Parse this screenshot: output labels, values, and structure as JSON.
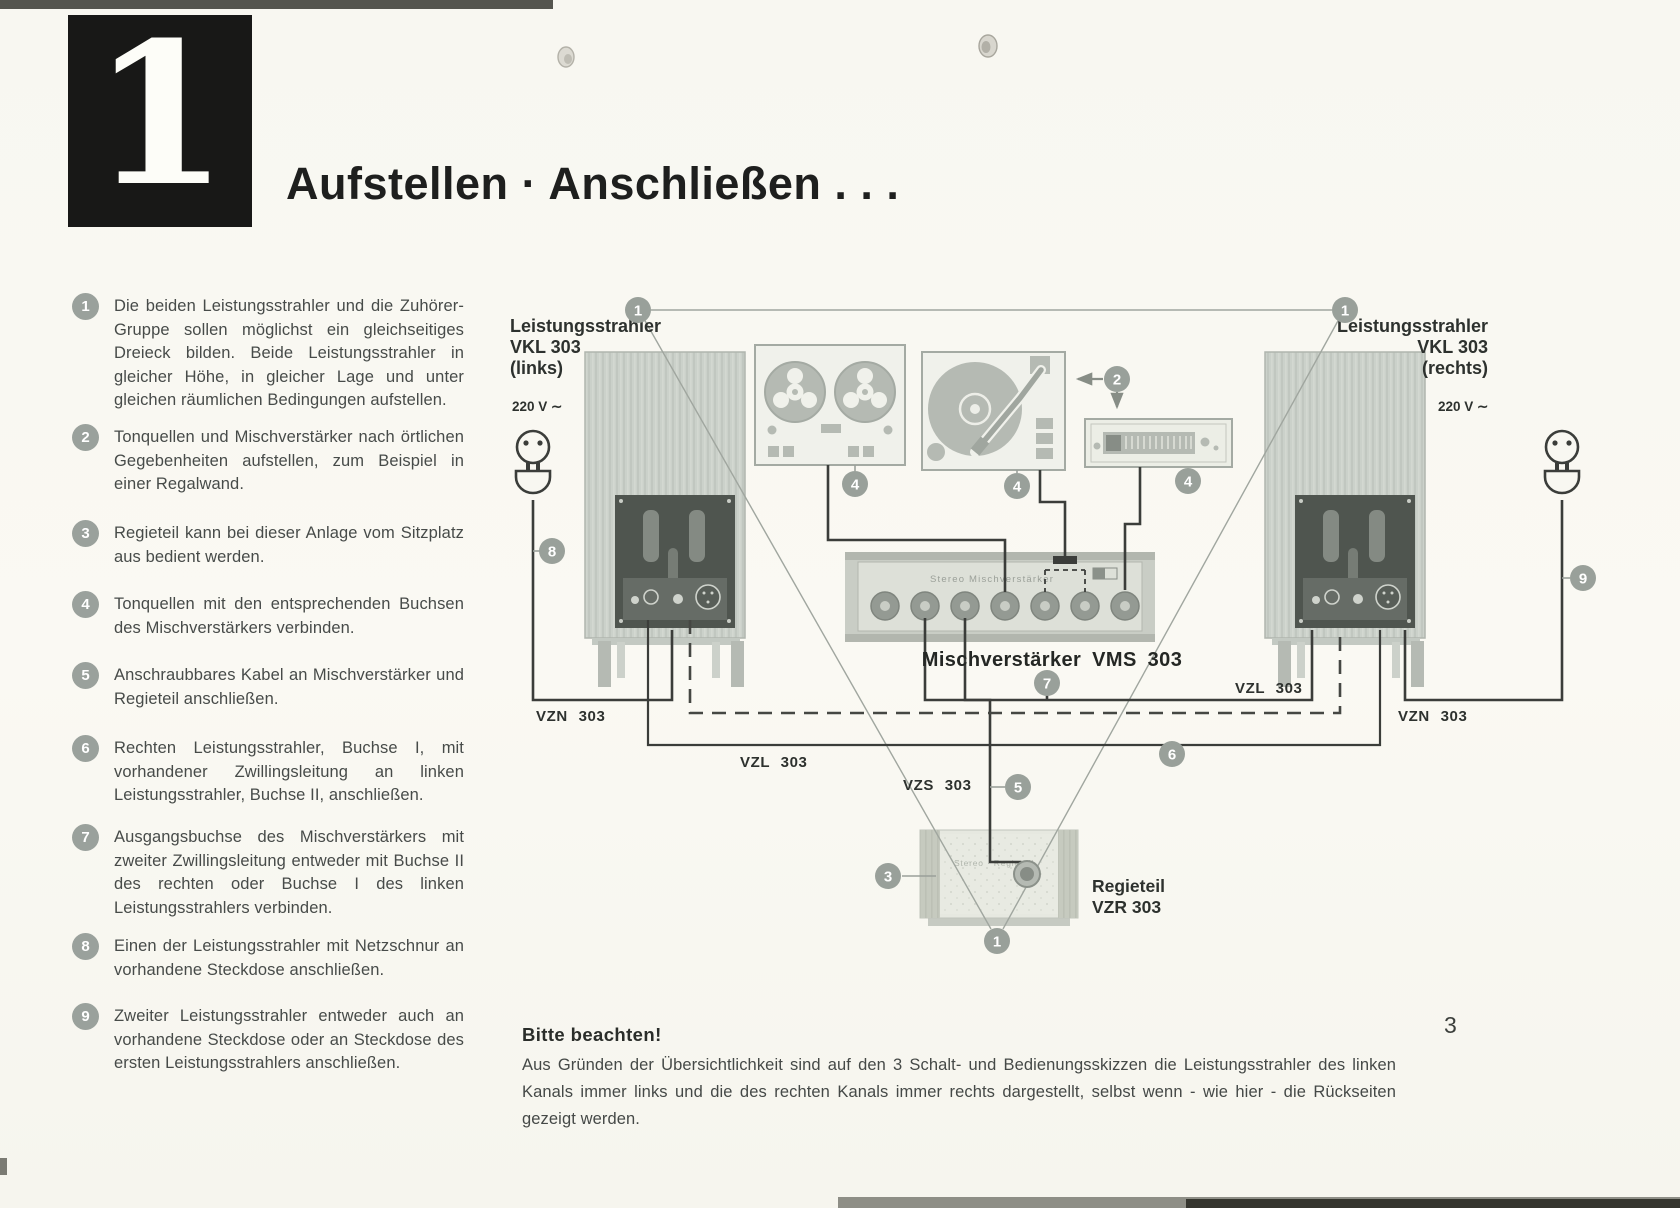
{
  "header": {
    "chapter_number": "1",
    "title": "Aufstellen · Anschließen . . ."
  },
  "page": {
    "number": "3"
  },
  "instructions": [
    {
      "num": "1",
      "text": "Die beiden Leistungsstrahler und die Zuhörer-Gruppe sollen möglichst ein gleichseitiges Dreieck bilden. Beide Leistungsstrahler in gleicher Höhe, in gleicher Lage und unter gleichen räumlichen Bedingungen aufstellen."
    },
    {
      "num": "2",
      "text": "Tonquellen und Mischverstärker nach örtlichen Gegebenheiten aufstellen, zum Beispiel in einer Regalwand."
    },
    {
      "num": "3",
      "text": "Regieteil kann bei dieser Anlage vom Sitzplatz aus bedient werden."
    },
    {
      "num": "4",
      "text": "Tonquellen mit den entsprechenden Buchsen des Mischverstärkers verbinden."
    },
    {
      "num": "5",
      "text": "Anschraubbares Kabel an Mischverstärker und Regieteil anschließen."
    },
    {
      "num": "6",
      "text": "Rechten Leistungsstrahler, Buchse I, mit vorhandener Zwillingsleitung an linken Leistungsstrahler, Buchse II, anschließen."
    },
    {
      "num": "7",
      "text": "Ausgangsbuchse des Mischverstärkers mit zweiter Zwillingsleitung entweder mit Buchse II des rechten oder Buchse I des linken Leistungsstrahlers verbinden."
    },
    {
      "num": "8",
      "text": "Einen der Leistungsstrahler mit Netzschnur an vorhandene Steckdose anschließen."
    },
    {
      "num": "9",
      "text": "Zweiter Leistungsstrahler entweder auch an vorhandene Steckdose oder an Steckdose des ersten Leistungsstrahlers anschließen."
    }
  ],
  "diagram": {
    "speaker_left_lines": [
      "Leistungsstrahler",
      "VKL 303",
      "(links)"
    ],
    "speaker_right_lines": [
      "Leistungsstrahler",
      "VKL 303",
      "(rechts)"
    ],
    "voltage_left": "220 V ∼",
    "voltage_right": "220 V ∼",
    "mixer_label": "Mischverstärker VMS 303",
    "mixer_panel_text": "Stereo Mischverstärker",
    "regie_panel_text": "Stereo · Regieteil",
    "regie_label_lines": [
      "Regieteil",
      "VZR 303"
    ],
    "cables": {
      "vzn_left": "VZN 303",
      "vzn_right": "VZN 303",
      "vzl_center": "VZL 303",
      "vzl_right": "VZL 303",
      "vzs": "VZS 303"
    },
    "markers": {
      "triangle_left": "1",
      "triangle_right": "1",
      "triangle_bottom": "1",
      "sources": "2",
      "regie": "3",
      "tape": "4",
      "turntable": "4",
      "tuner": "4",
      "vzs": "5",
      "link": "6",
      "output": "7",
      "mains_left": "8",
      "mains_right": "9"
    }
  },
  "note": {
    "heading": "Bitte beachten!",
    "body": "Aus Gründen der Übersichtlichkeit sind auf den 3 Schalt- und Bedienungsskizzen die Leistungsstrahler des linken Kanals immer links und die des rechten Kanals immer rechts dargestellt, selbst wenn - wie hier - die Rückseiten gezeigt werden."
  },
  "colors": {
    "paper": "#f8f7f1",
    "ink": "#2d312e",
    "body_text": "#474b49",
    "marker_gray": "#99a09a",
    "device_gray": "#b5bab3",
    "panel_dark": "#4f554f",
    "wire": "#3b3d3a"
  }
}
